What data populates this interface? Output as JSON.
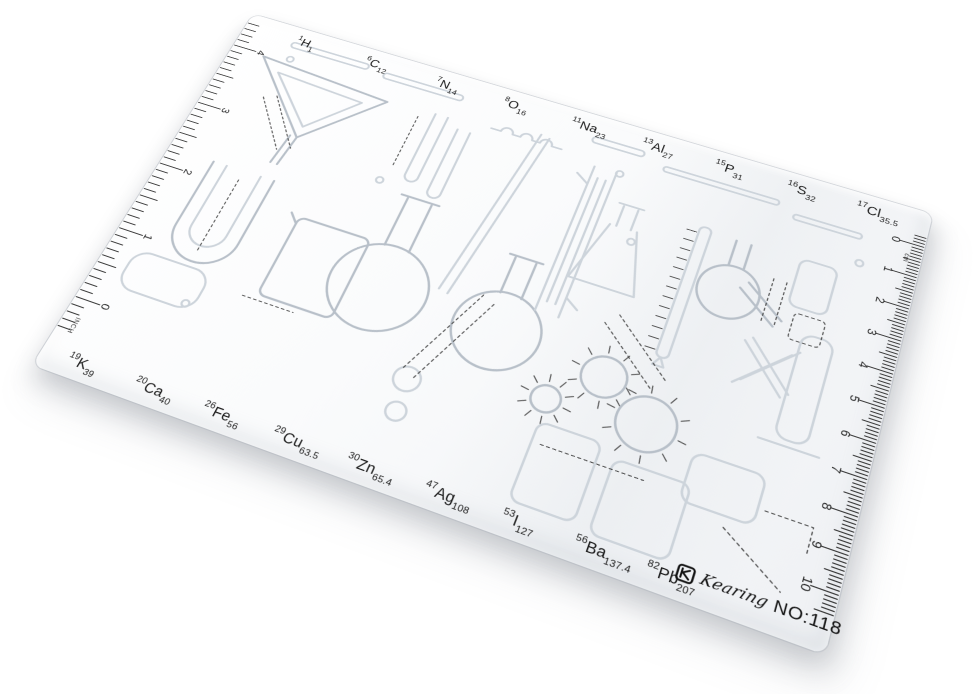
{
  "product": {
    "brand_script": "Kearing",
    "model": "NO:118"
  },
  "colors": {
    "ink": "#1b1b1b",
    "emboss": "#cdd4db",
    "emboss_dark": "#b8c0c9",
    "dotted_guide": "#3f3f3f",
    "sheet_high": "#ffffff",
    "sheet_low": "#eff1f4"
  },
  "rulers": {
    "left": {
      "unit": "INCH",
      "numbers": [
        "4",
        "3",
        "2",
        "1",
        "0"
      ]
    },
    "right": {
      "unit": "cm",
      "numbers": [
        "0",
        "1",
        "2",
        "3",
        "4",
        "5",
        "6",
        "7",
        "8",
        "9",
        "10"
      ]
    }
  },
  "elements": {
    "top": [
      {
        "z": "1",
        "sym": "H",
        "m": "1"
      },
      {
        "z": "6",
        "sym": "C",
        "m": "12"
      },
      {
        "z": "7",
        "sym": "N",
        "m": "14"
      },
      {
        "z": "8",
        "sym": "O",
        "m": "16"
      },
      {
        "z": "11",
        "sym": "Na",
        "m": "23"
      },
      {
        "z": "13",
        "sym": "Al",
        "m": "27"
      },
      {
        "z": "15",
        "sym": "P",
        "m": "31"
      },
      {
        "z": "16",
        "sym": "S",
        "m": "32"
      },
      {
        "z": "17",
        "sym": "Cl",
        "m": "35.5"
      }
    ],
    "bottom": [
      {
        "z": "19",
        "sym": "K",
        "m": "39"
      },
      {
        "z": "20",
        "sym": "Ca",
        "m": "40"
      },
      {
        "z": "26",
        "sym": "Fe",
        "m": "56"
      },
      {
        "z": "29",
        "sym": "Cu",
        "m": "63.5"
      },
      {
        "z": "30",
        "sym": "Zn",
        "m": "65.4"
      },
      {
        "z": "47",
        "sym": "Ag",
        "m": "108"
      },
      {
        "z": "53",
        "sym": "I",
        "m": "127"
      },
      {
        "z": "56",
        "sym": "Ba",
        "m": "137.4"
      },
      {
        "z": "82",
        "sym": "Pb",
        "m": "207"
      }
    ]
  }
}
